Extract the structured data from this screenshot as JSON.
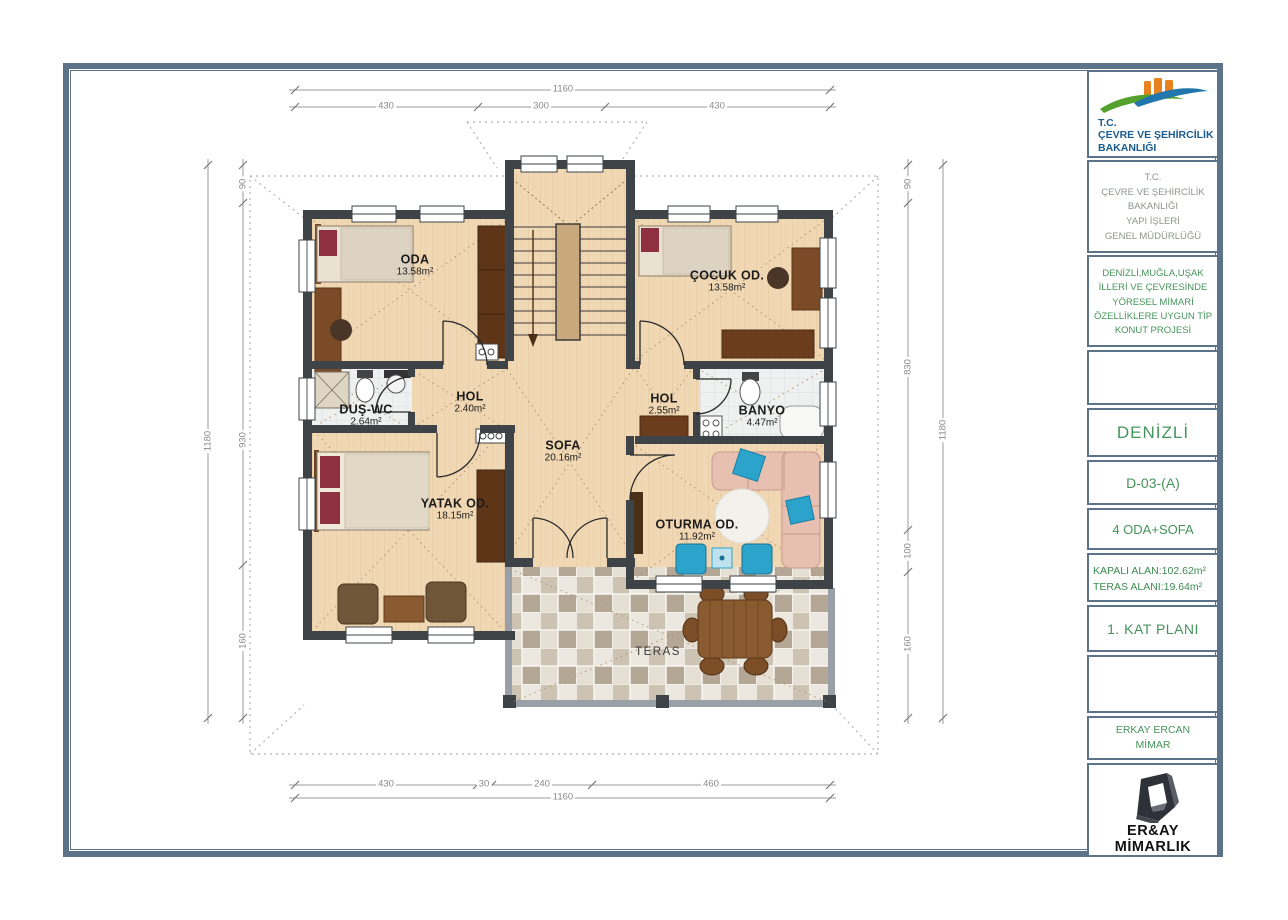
{
  "title_block": {
    "logo_lines": [
      "T.C.",
      "ÇEVRE VE ŞEHİRCİLİK",
      "BAKANLIĞI"
    ],
    "ministry_lines": [
      "T.C.",
      "ÇEVRE VE ŞEHİRCİLİK",
      "BAKANLIĞI",
      "YAPI İŞLERİ",
      "GENEL MÜDÜRLÜĞÜ"
    ],
    "project_lines": [
      "DENİZLİ,MUĞLA,UŞAK",
      "İLLERİ VE ÇEVRESİNDE",
      "YÖRESEL MİMARİ",
      "ÖZELLİKLERE UYGUN TİP",
      "KONUT PROJESİ"
    ],
    "city": "DENİZLİ",
    "code": "D-03-(A)",
    "house_type": "4 ODA+SOFA",
    "area_lines": [
      "KAPALI ALAN:102.62m²",
      "TERAS ALANI:19.64m²"
    ],
    "plan_name": "1. KAT PLANI",
    "architect_lines": [
      "ERKAY ERCAN",
      "MİMAR"
    ],
    "firm": "ER&AY MİMARLIK",
    "firm_email": "e-mail: eraymim@gmail.com"
  },
  "rooms": [
    {
      "name": "ODA",
      "area": "13.58m²"
    },
    {
      "name": "ÇOCUK OD.",
      "area": "13.58m²"
    },
    {
      "name": "HOL",
      "area": "2.40m²"
    },
    {
      "name": "DUŞ-WC",
      "area": "2.64m²"
    },
    {
      "name": "HOL",
      "area": "2.55m²"
    },
    {
      "name": "BANYO",
      "area": "4.47m²"
    },
    {
      "name": "SOFA",
      "area": "20.16m²"
    },
    {
      "name": "YATAK OD.",
      "area": "18.15m²"
    },
    {
      "name": "OTURMA OD.",
      "area": "11.92m²"
    },
    {
      "name": "TERAS",
      "area": ""
    }
  ],
  "dimensions": {
    "top": {
      "total": "1160",
      "segments": [
        "430",
        "300",
        "430"
      ]
    },
    "bottom": {
      "total": "1160",
      "segments": [
        "430",
        "30",
        "240",
        "460"
      ]
    },
    "left": {
      "total": "1180",
      "segments": [
        "90",
        "930",
        "160"
      ]
    },
    "right": {
      "total": "1180",
      "segments": [
        "90",
        "830",
        "100",
        "160"
      ]
    }
  },
  "colors": {
    "frame": "#5c7389",
    "wall": "#3e4347",
    "floor_wood": "#f1d8b4",
    "green_text": "#46945b",
    "blue_text": "#1a5c8f",
    "dim_text": "#8a8a8a",
    "sofa_pink": "#e7c0b2",
    "accent_blue": "#2ba3cb",
    "logo_orange": "#e8821e",
    "logo_green": "#55a12d",
    "logo_blue": "#2176ad"
  }
}
